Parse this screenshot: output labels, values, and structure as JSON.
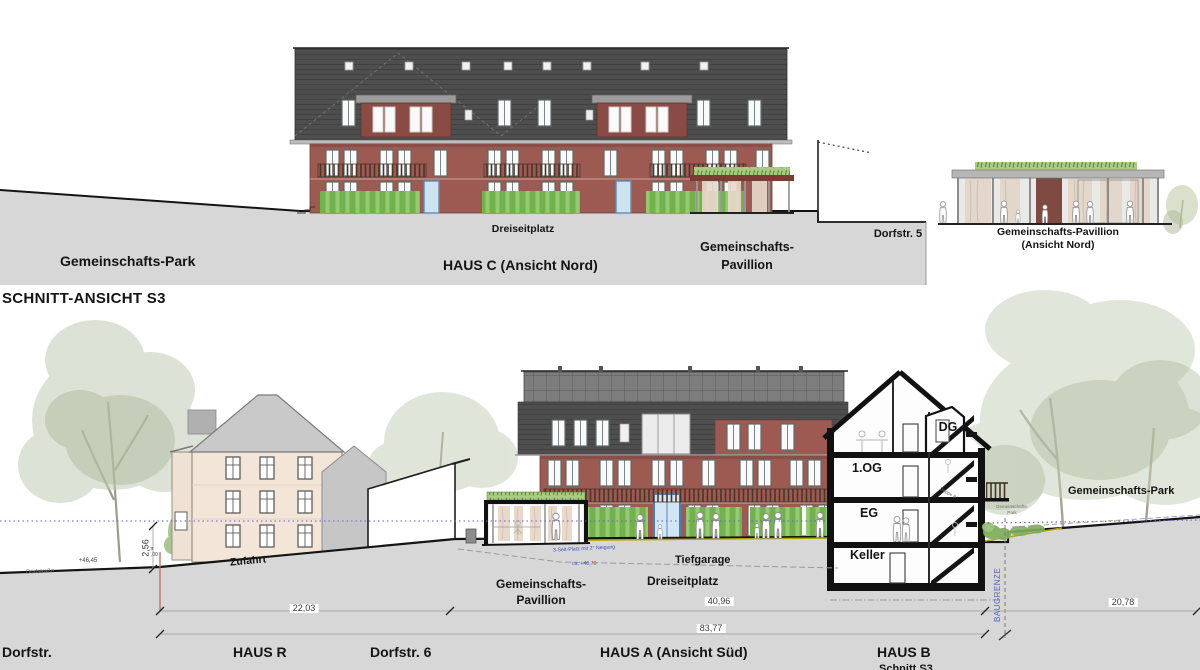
{
  "top_view": {
    "park_label": "Gemeinschafts-Park",
    "dreiseitplatz_label": "Dreiseitplatz",
    "haus_c_label": "HAUS C (Ansicht Nord)",
    "pavillion_label_line1": "Gemeinschafts-",
    "pavillion_label_line2": "Pavillion",
    "dorfstr5_label": "Dorfstr. 5",
    "pavillion_nord_label_line1": "Gemeinschafts-Pavillion",
    "pavillion_nord_label_line2": "(Ansicht Nord)"
  },
  "section_title": "SCHNITT-ANSICHT  S3",
  "section": {
    "street_label": "Dorfstr.",
    "haus_r_label": "HAUS R",
    "dorfstr6_label": "Dorfstr. 6",
    "haus_a_label": "HAUS A (Ansicht Süd)",
    "haus_b_label": "HAUS B",
    "haus_b_sublabel": "Schnitt S3",
    "zufahrt_label": "Zufahrt",
    "dorfstrasse_label": "Dorfstraße",
    "tor_label_line1": "Tor",
    "tor_label_line2": "+47,00",
    "level_4645": "+46,45",
    "tiefgarage_label": "Tiefgarage",
    "dreiseitplatz_label": "Dreiseitplatz",
    "pavillion_label_line1": "Gemeinschafts-",
    "pavillion_label_line2": "Pavillion",
    "slope_note": "3-Seit-Platz mit 2° Neigung",
    "level_note_prefix": "ca. +46,",
    "level_note_suffix": "70",
    "park_label": "Gemeinschafts-Park",
    "park_small_line1": "Gemeinschafts-",
    "park_small_line2": "Park",
    "baugrenze_label": "BAUGRENZE",
    "floors": {
      "dg": "DG",
      "og": "1.OG",
      "eg": "EG",
      "keller": "Keller",
      "treppe": "Treppe B"
    },
    "dimensions": {
      "zufahrt_width": "22,03",
      "platz_width": "40,96",
      "total_width": "83,77",
      "park_width": "20,78",
      "street_height": "2,56"
    }
  },
  "colors": {
    "facade": "#9d5a52",
    "roof": "#4f4f4f",
    "hedge": "#72b14c",
    "ground": "#d7d7d7",
    "datum": "#6a5acf",
    "note_blue": "#3f4ec4",
    "note_red": "#c34040"
  }
}
